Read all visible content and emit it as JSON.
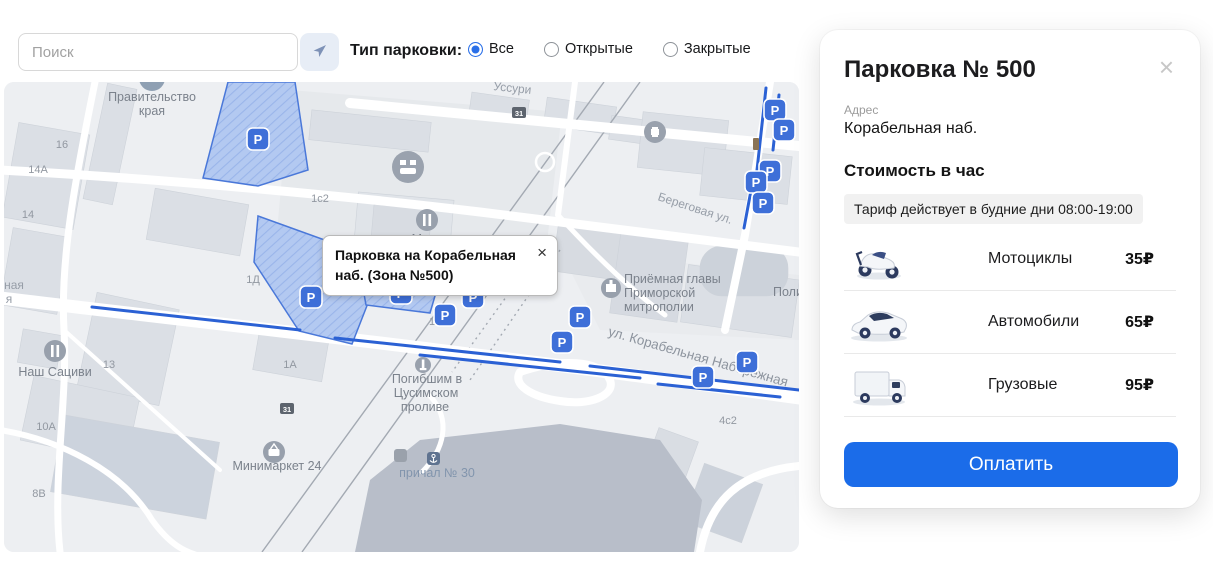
{
  "icons": {
    "close": "×"
  },
  "top_bar": {
    "search": {
      "placeholder": "Поиск"
    },
    "filter_label": "Тип парковки:",
    "radios": [
      {
        "label": "Все",
        "selected": true
      },
      {
        "label": "Открытые",
        "selected": false
      },
      {
        "label": "Закрытые",
        "selected": false
      }
    ]
  },
  "map": {
    "popup": {
      "text": "Парковка на Корабельная наб. (Зона №500)"
    },
    "marker_letter": "P",
    "markers": [
      {
        "x": 775,
        "y": 110
      },
      {
        "x": 784,
        "y": 130
      },
      {
        "x": 770,
        "y": 171
      },
      {
        "x": 756,
        "y": 182
      },
      {
        "x": 763,
        "y": 203
      },
      {
        "x": 258,
        "y": 139
      },
      {
        "x": 311,
        "y": 297
      },
      {
        "x": 401,
        "y": 293
      },
      {
        "x": 445,
        "y": 315
      },
      {
        "x": 473,
        "y": 297
      },
      {
        "x": 580,
        "y": 317
      },
      {
        "x": 562,
        "y": 342
      },
      {
        "x": 747,
        "y": 362
      },
      {
        "x": 703,
        "y": 377
      }
    ],
    "street_labels": [
      {
        "text": "Уссури",
        "x": 512,
        "y": 92,
        "rot": 6,
        "cls": "lbl-st"
      },
      {
        "text": "Береговая ул.",
        "x": 694,
        "y": 212,
        "rot": 18,
        "cls": "lbl-st"
      },
      {
        "text": "ул. Корабельная Набережная",
        "x": 697,
        "y": 361,
        "rot": 16,
        "cls": "lbl-st-big"
      },
      {
        "text": "ная",
        "x": 14,
        "y": 289,
        "rot": 0,
        "cls": "lbl-st"
      },
      {
        "text": "я",
        "x": 9,
        "y": 303,
        "rot": 0,
        "cls": "lbl-st"
      }
    ],
    "poi_labels": [
      {
        "text": "Правительство",
        "x": 152,
        "y": 101
      },
      {
        "text": "края",
        "x": 152,
        "y": 115
      },
      {
        "text": "Москва",
        "x": 433,
        "y": 243
      },
      {
        "text": "Наш Сациви",
        "x": 55,
        "y": 376
      },
      {
        "text": "Приёмная главы",
        "x": 624,
        "y": 283,
        "anchor": "start"
      },
      {
        "text": "Приморской",
        "x": 624,
        "y": 297,
        "anchor": "start"
      },
      {
        "text": "митрополии",
        "x": 624,
        "y": 311,
        "anchor": "start"
      },
      {
        "text": "Поли",
        "x": 773,
        "y": 296,
        "anchor": "start"
      },
      {
        "text": "Минимаркет 24",
        "x": 277,
        "y": 470
      },
      {
        "text": "Погибшим в",
        "x": 427,
        "y": 383
      },
      {
        "text": "Цусимском",
        "x": 426,
        "y": 397
      },
      {
        "text": "проливе",
        "x": 425,
        "y": 411
      },
      {
        "text": "причал № 30",
        "x": 437,
        "y": 477,
        "cls": "lbl-pier"
      }
    ],
    "house_numbers": [
      {
        "text": "16",
        "x": 62,
        "y": 148
      },
      {
        "text": "14А",
        "x": 38,
        "y": 173
      },
      {
        "text": "14",
        "x": 28,
        "y": 218
      },
      {
        "text": "1с2",
        "x": 320,
        "y": 202
      },
      {
        "text": "1Д",
        "x": 253,
        "y": 283
      },
      {
        "text": "13",
        "x": 109,
        "y": 368
      },
      {
        "text": "10А",
        "x": 46,
        "y": 430
      },
      {
        "text": "8В",
        "x": 39,
        "y": 497
      },
      {
        "text": "1А",
        "x": 290,
        "y": 368
      },
      {
        "text": "1",
        "x": 432,
        "y": 325
      },
      {
        "text": "4с2",
        "x": 728,
        "y": 424
      }
    ],
    "badges": [
      {
        "text": "31",
        "x": 519,
        "y": 113
      },
      {
        "text": "31",
        "x": 287,
        "y": 409
      }
    ]
  },
  "panel": {
    "title": "Парковка № 500",
    "address_label": "Адрес",
    "address_value": "Корабельная наб.",
    "section_title": "Стоимость в час",
    "tariff_note": "Тариф действует в будние дни 08:00-19:00",
    "rows": [
      {
        "vehicle": "Мотоциклы",
        "price_label": "35₽"
      },
      {
        "vehicle": "Автомобили",
        "price_label": "65₽"
      },
      {
        "vehicle": "Грузовые",
        "price_label": "95₽"
      }
    ],
    "pay_button": "Оплатить"
  },
  "colors": {
    "accent_blue": "#1b6ce9",
    "parking_marker": "#3e6fd8",
    "parking_zone_fill": "#b3c9f1",
    "parking_zone_stroke": "#4a78d9",
    "water": "#b8bec9"
  }
}
